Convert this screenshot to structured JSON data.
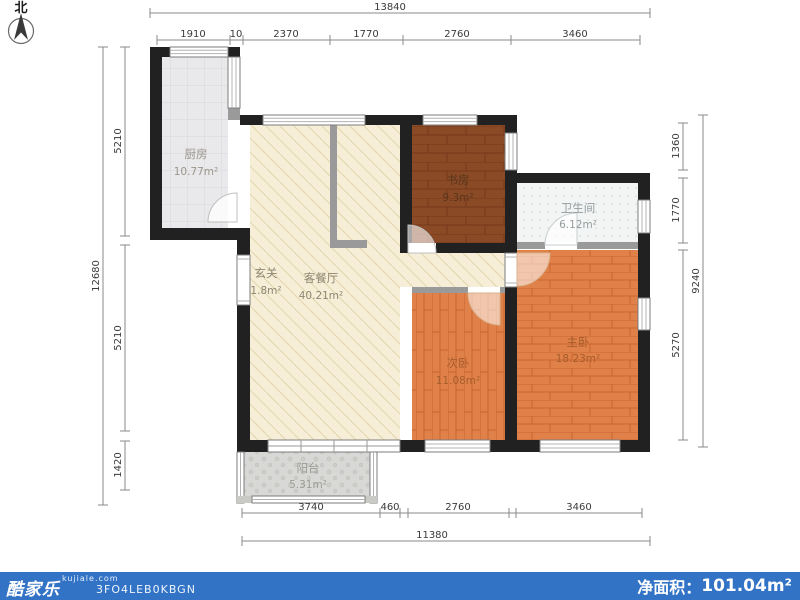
{
  "compass": {
    "label": "北"
  },
  "rooms": {
    "kitchen": {
      "name": "厨房",
      "area": "10.77m²"
    },
    "study": {
      "name": "书房",
      "area": "9.3m²"
    },
    "bathroom": {
      "name": "卫生间",
      "area": "6.12m²"
    },
    "entry": {
      "name": "玄关",
      "area": "1.8m²"
    },
    "living": {
      "name": "客餐厅",
      "area": "40.21m²"
    },
    "bedroom2": {
      "name": "次卧",
      "area": "11.08m²"
    },
    "master": {
      "name": "主卧",
      "area": "18.23m²"
    },
    "balcony": {
      "name": "阳台",
      "area": "5.31m²"
    }
  },
  "dims": {
    "top_total": "13840",
    "top": [
      "1910",
      "10",
      "2370",
      "1770",
      "2760",
      "3460"
    ],
    "left_total": "12680",
    "left": [
      "5210",
      "5210",
      "1420"
    ],
    "right_total": "9240",
    "right": [
      "1360",
      "1770",
      "5270"
    ],
    "bottom": [
      "3740",
      "460",
      "2760",
      "3460"
    ],
    "bottom_total": "11380"
  },
  "footer": {
    "brand": "酷家乐",
    "site": "kujiale.com",
    "code": "3FO4LEB0KBGN",
    "net_area_label": "净面积：",
    "net_area_value": "101.04m²"
  },
  "colors": {
    "wall": "#212121",
    "partition": "#9a9a9a",
    "accent_bar": "#3273c6",
    "living_floor": "#f6eed6",
    "kitchen_floor": "#e9e9eb",
    "study_floor": "#8a4a26",
    "bedroom_floor": "#e0814a",
    "bathroom_floor": "#f3f5f5",
    "balcony_floor": "#d8d8d6"
  }
}
